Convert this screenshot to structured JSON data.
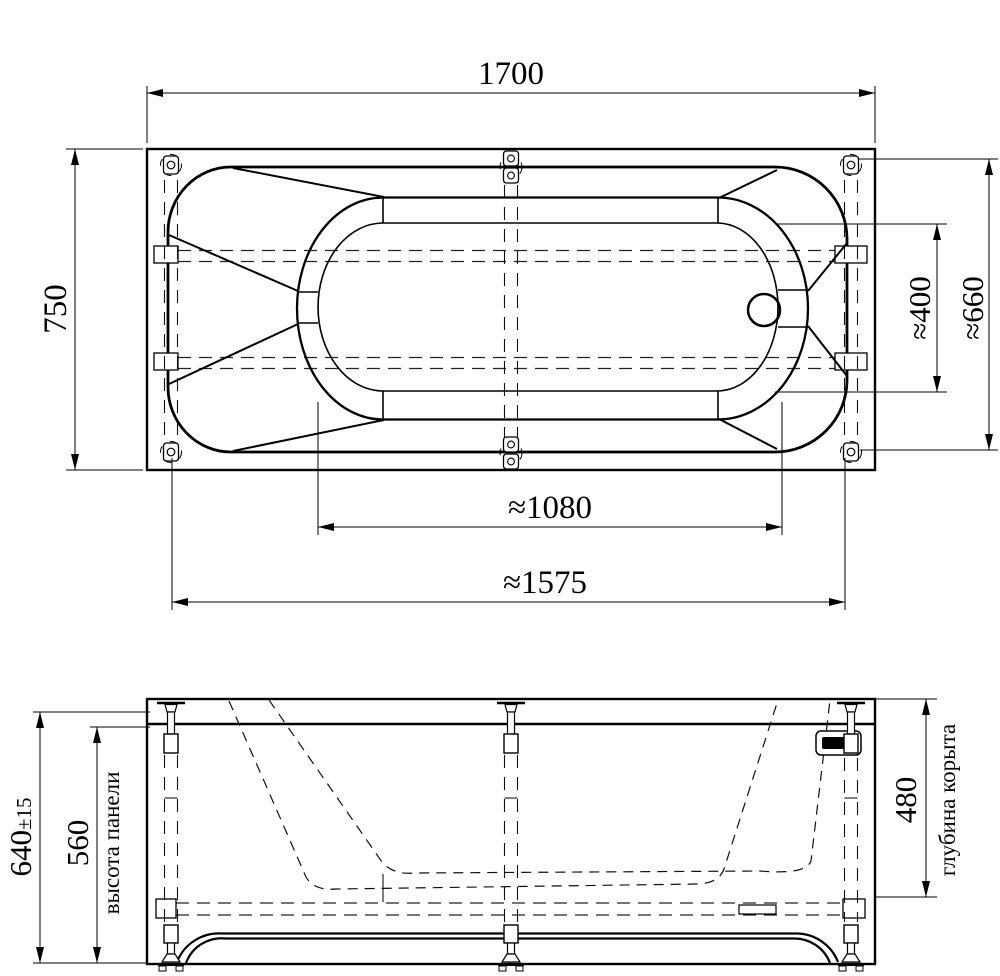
{
  "drawing": {
    "type": "bathtub-technical-drawing",
    "plan": {
      "dims": {
        "length": "1700",
        "width": "750",
        "drain_end_inner_width": "≈400",
        "end_width": "≈660",
        "bottom_length": "≈1080",
        "support_span": "≈1575"
      }
    },
    "elevation": {
      "dims": {
        "total_height": "640",
        "total_height_tol": "±15",
        "panel_height": "560",
        "bowl_depth": "480"
      },
      "labels": {
        "panel_height": "высота панели",
        "bowl_depth": "глубина корыта"
      }
    }
  }
}
